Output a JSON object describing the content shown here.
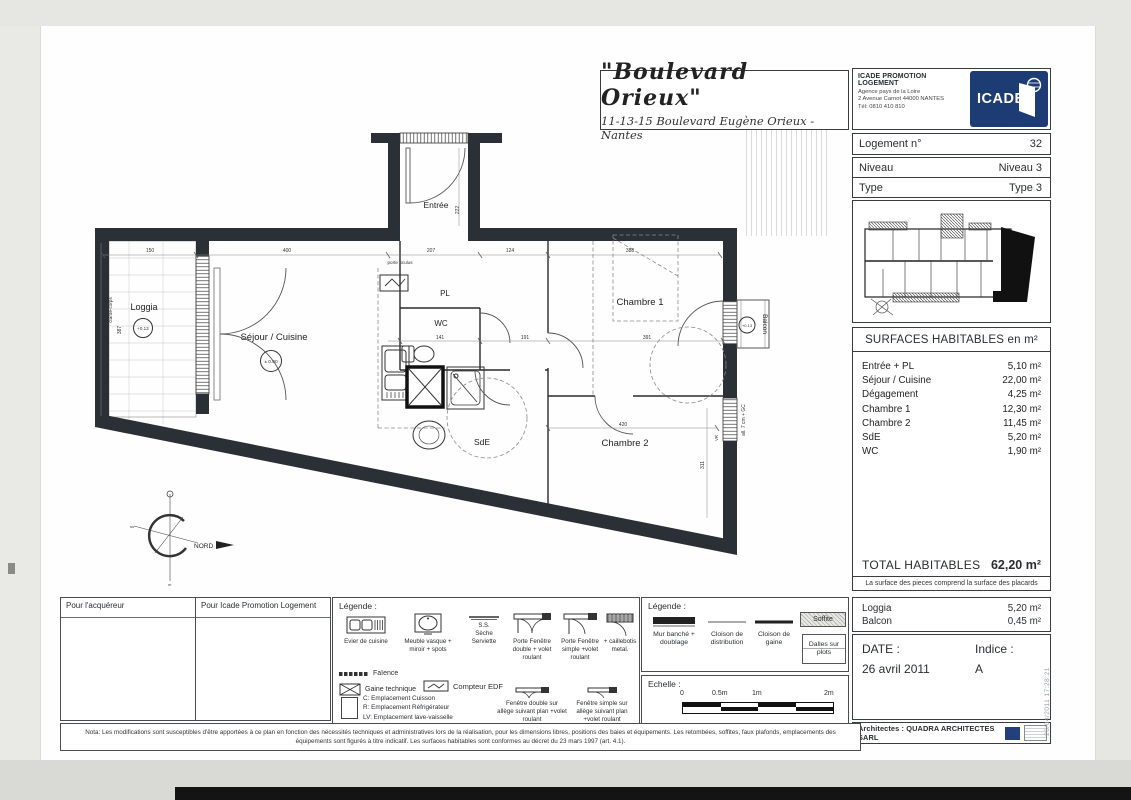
{
  "colors": {
    "brand_blue": "#1e3c74",
    "wall": "#2b3036"
  },
  "header": {
    "title": "\"Boulevard Orieux\"",
    "subtitle": "11-13-15 Boulevard Eugène Orieux - Nantes",
    "promoter": {
      "name": "ICADE PROMOTION LOGEMENT",
      "line1": "Agence pays de la Loire",
      "line2": "2 Avenue Carnot 44000 NANTES",
      "line3": "Tél: 0810 410 810",
      "logo": "ICADE"
    },
    "logement_label": "Logement n°",
    "logement_value": "32",
    "niveau_label": "Niveau",
    "niveau_value": "Niveau 3",
    "type_label": "Type",
    "type_value": "Type 3"
  },
  "surfaces": {
    "title": "SURFACES HABITABLES en m²",
    "rows": [
      {
        "label": "Entrée + PL",
        "value": "5,10 m²"
      },
      {
        "label": "Séjour / Cuisine",
        "value": "22,00 m²"
      },
      {
        "label": "Dégagement",
        "value": "4,25 m²"
      },
      {
        "label": "Chambre 1",
        "value": "12,30 m²"
      },
      {
        "label": "Chambre 2",
        "value": "11,45 m²"
      },
      {
        "label": "SdE",
        "value": "5,20 m²"
      },
      {
        "label": "WC",
        "value": "1,90 m²"
      }
    ],
    "total_label": "TOTAL HABITABLES",
    "total_value": "62,20 m²",
    "footnote": "La surface des pieces comprend la surface des placards"
  },
  "annexes": {
    "rows": [
      {
        "label": "Loggia",
        "value": "5,20 m²"
      },
      {
        "label": "Balcon",
        "value": "0,45 m²"
      }
    ]
  },
  "date_block": {
    "date_label": "DATE :",
    "date_value": "26 avril 2011",
    "indice_label": "Indice :",
    "indice_value": "A"
  },
  "architects": "Architectes : QUADRA ARCHITECTES SARL",
  "timestamp": "26/04/2011 17:28:21",
  "signatures": {
    "left": "Pour l'acquéreur",
    "right": "Pour Icade Promotion Logement"
  },
  "legend_fixtures": {
    "title": "Légende :",
    "evier": "Evier de cuisine",
    "vasque": "Meuble vasque + miroir + spots",
    "seche": "Sèche Serviette",
    "ss": "S.S.",
    "pf_double": "Porte Fenêtre double + volet roulant",
    "pf_simple": "Porte Fenêtre simple +volet roulant",
    "caillebotis": "+ caillebotis metal.",
    "faience": "Faïence",
    "gaine": "Gaine technique",
    "compteur": "Compteur EDF",
    "c": "C: Emplacement Cuisson",
    "r": "R: Emplacement Réfrigérateur",
    "lv": "LV: Emplacement lave-vaisselle",
    "ll": "LL: Emplacement lave-linge",
    "fen_double": "Fenêtre double sur allège suivant plan +volet roulant",
    "fen_simple": "Fenêtre simple sur allège suivant plan +volet roulant"
  },
  "legend_walls": {
    "title": "Légende :",
    "mur": "Mur banché + doublage",
    "cloison_dist": "Cloison de distribution",
    "cloison_gaine": "Cloison de gaine",
    "soffite": "Soffite",
    "dalles": "Dalles sur plots"
  },
  "scale_block": {
    "title": "Echelle :",
    "t0": "0",
    "t05": "0.5m",
    "t1": "1m",
    "t2": "2m"
  },
  "nota": "Nota: Les modifications sont susceptibles d'être apportées à ce plan en fonction des nécessités techniques et administratives lors de la réalisation, pour les dimensions libres, positions des baies et équipements. Les retombées, soffites, faux plafonds, emplacements des équipements sont figurés à titre indicatif. Les surfaces habitables sont conformes au décret du 23 mars 1997 (art. 4.1).",
  "plan": {
    "rooms": {
      "loggia": "Loggia",
      "sejour": "Séjour / Cuisine",
      "entree": "Entrée",
      "pl": "PL",
      "wc": "WC",
      "sde": "SdE",
      "chambre1": "Chambre 1",
      "chambre2": "Chambre 2",
      "balcon": "Balcon"
    },
    "levels": {
      "loggia": "+0.13",
      "sejour": "± 0.00",
      "balcon": "+0.13"
    },
    "dims": {
      "d150": "150",
      "d400": "400",
      "d207": "207",
      "d124": "124",
      "d388": "388",
      "d222": "222",
      "d141": "141",
      "d191": "191",
      "d391": "391",
      "d420": "420",
      "d311": "311",
      "d387": "387"
    },
    "annotations": {
      "porte_oculus": "porte oculus",
      "garde_corps": "Garde-corps",
      "allege": "all. 7 cm + GC",
      "vr": "VR",
      "nord": "NORD"
    }
  }
}
